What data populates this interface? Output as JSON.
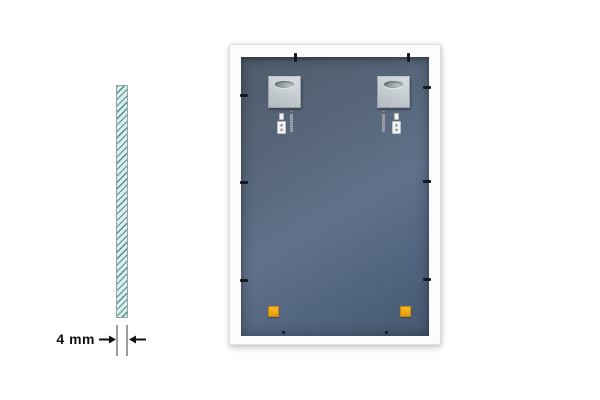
{
  "image": {
    "description": "Product illustration: back of a white-framed mirror with mounting hardware, and a side profile of the 4 mm glass"
  },
  "side_view": {
    "dimension_label": "4 mm"
  },
  "back_view": {
    "parts": {
      "hanging_plates": "two silver keyhole hanging plates",
      "anchors": "two white wall plugs",
      "screws": "two screws",
      "retainer_clips": "black frame clips on all edges",
      "bumpers": "two yellow corner pads"
    }
  },
  "colors": {
    "page-bg": "#ffffff",
    "dim-text": "#111111",
    "arrow": "#111111",
    "ext-line": "#9aa0a0",
    "glass-fill": "#dcedeb",
    "glass-hatch": "#4e918e",
    "glass-border": "#98a2a2",
    "frame": "#fcfcfc",
    "frame-edge": "#dedede",
    "panel-top": "#4f5b6a",
    "panel-mid": "#60718a",
    "panel-bottom": "#455970",
    "plate": "#c4ccd1",
    "plate-dark": "#aeb7bc",
    "slot": "#7f878c",
    "clip": "#17191c",
    "anchor": "#f1f2f2",
    "screw": "#868e94",
    "bumper": "#eeaa14",
    "bumper-edge": "#c8880e"
  }
}
